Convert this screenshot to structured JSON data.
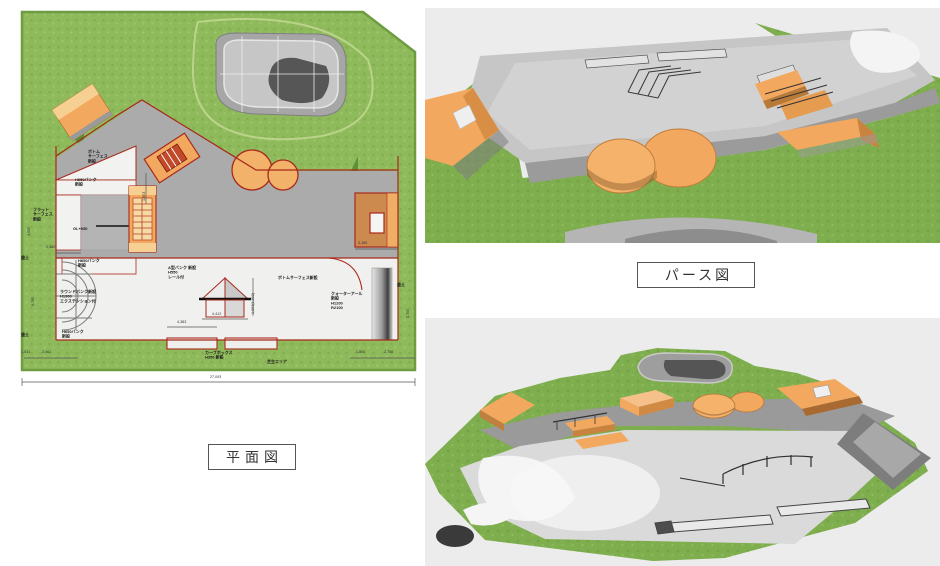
{
  "captions": {
    "plan": "平面図",
    "perspective": "パース図"
  },
  "colors": {
    "grass": "#8fba5c",
    "grass-dark": "#5e8f38",
    "grass-edge": "#6d9c41",
    "concrete": "#ababab",
    "concrete-light": "#dedede",
    "concrete-white": "#f0f0ee",
    "orange": "#f2a95f",
    "orange-light": "#f6cf92",
    "orange-dark": "#c8843f",
    "outline-red": "#a8291b",
    "bg-render": "#ececec",
    "ink": "#1c1c1c"
  },
  "plan": {
    "labels": [
      {
        "id": "bottom-surface-top",
        "text": "ボトム\nサーフェス\n新設"
      },
      {
        "id": "h650-bank-top",
        "text": "H650バンク\n新設"
      },
      {
        "id": "flat-surface",
        "text": "フラット\nサーフェス\n新設"
      },
      {
        "id": "gl650",
        "text": "GL+650"
      },
      {
        "id": "h650-bank-mid",
        "text": "H650バンク\n新設"
      },
      {
        "id": "round-bank",
        "text": "ラウンドバンク新設\nH1300\nエクステンション付"
      },
      {
        "id": "h650-bank-bottom",
        "text": "H650バンク\n新設"
      },
      {
        "id": "a-type-bank",
        "text": "A型バンク 新設\nH550\nレール付"
      },
      {
        "id": "bottom-surface-main",
        "text": "ボトムサーフェス新設"
      },
      {
        "id": "quarter-r",
        "text": "クォーターアール\n新設\nH1200\nR2100"
      },
      {
        "id": "curb-box",
        "text": "カーブボックス\nH350 新設"
      },
      {
        "id": "lawn-area",
        "text": "芝生エリア"
      },
      {
        "id": "embankment-left-top",
        "text": "盛土"
      },
      {
        "id": "embankment-left-bottom",
        "text": "盛土"
      },
      {
        "id": "embankment-right",
        "text": "盛土"
      }
    ],
    "dims": [
      "2,482",
      "1,803",
      "3,165",
      "4,000",
      "6,750",
      "5,700",
      "4,383",
      "4,412",
      "1,893(1,892)",
      "1,031",
      "2,461",
      "1,800",
      "2,756",
      "27,093"
    ]
  }
}
